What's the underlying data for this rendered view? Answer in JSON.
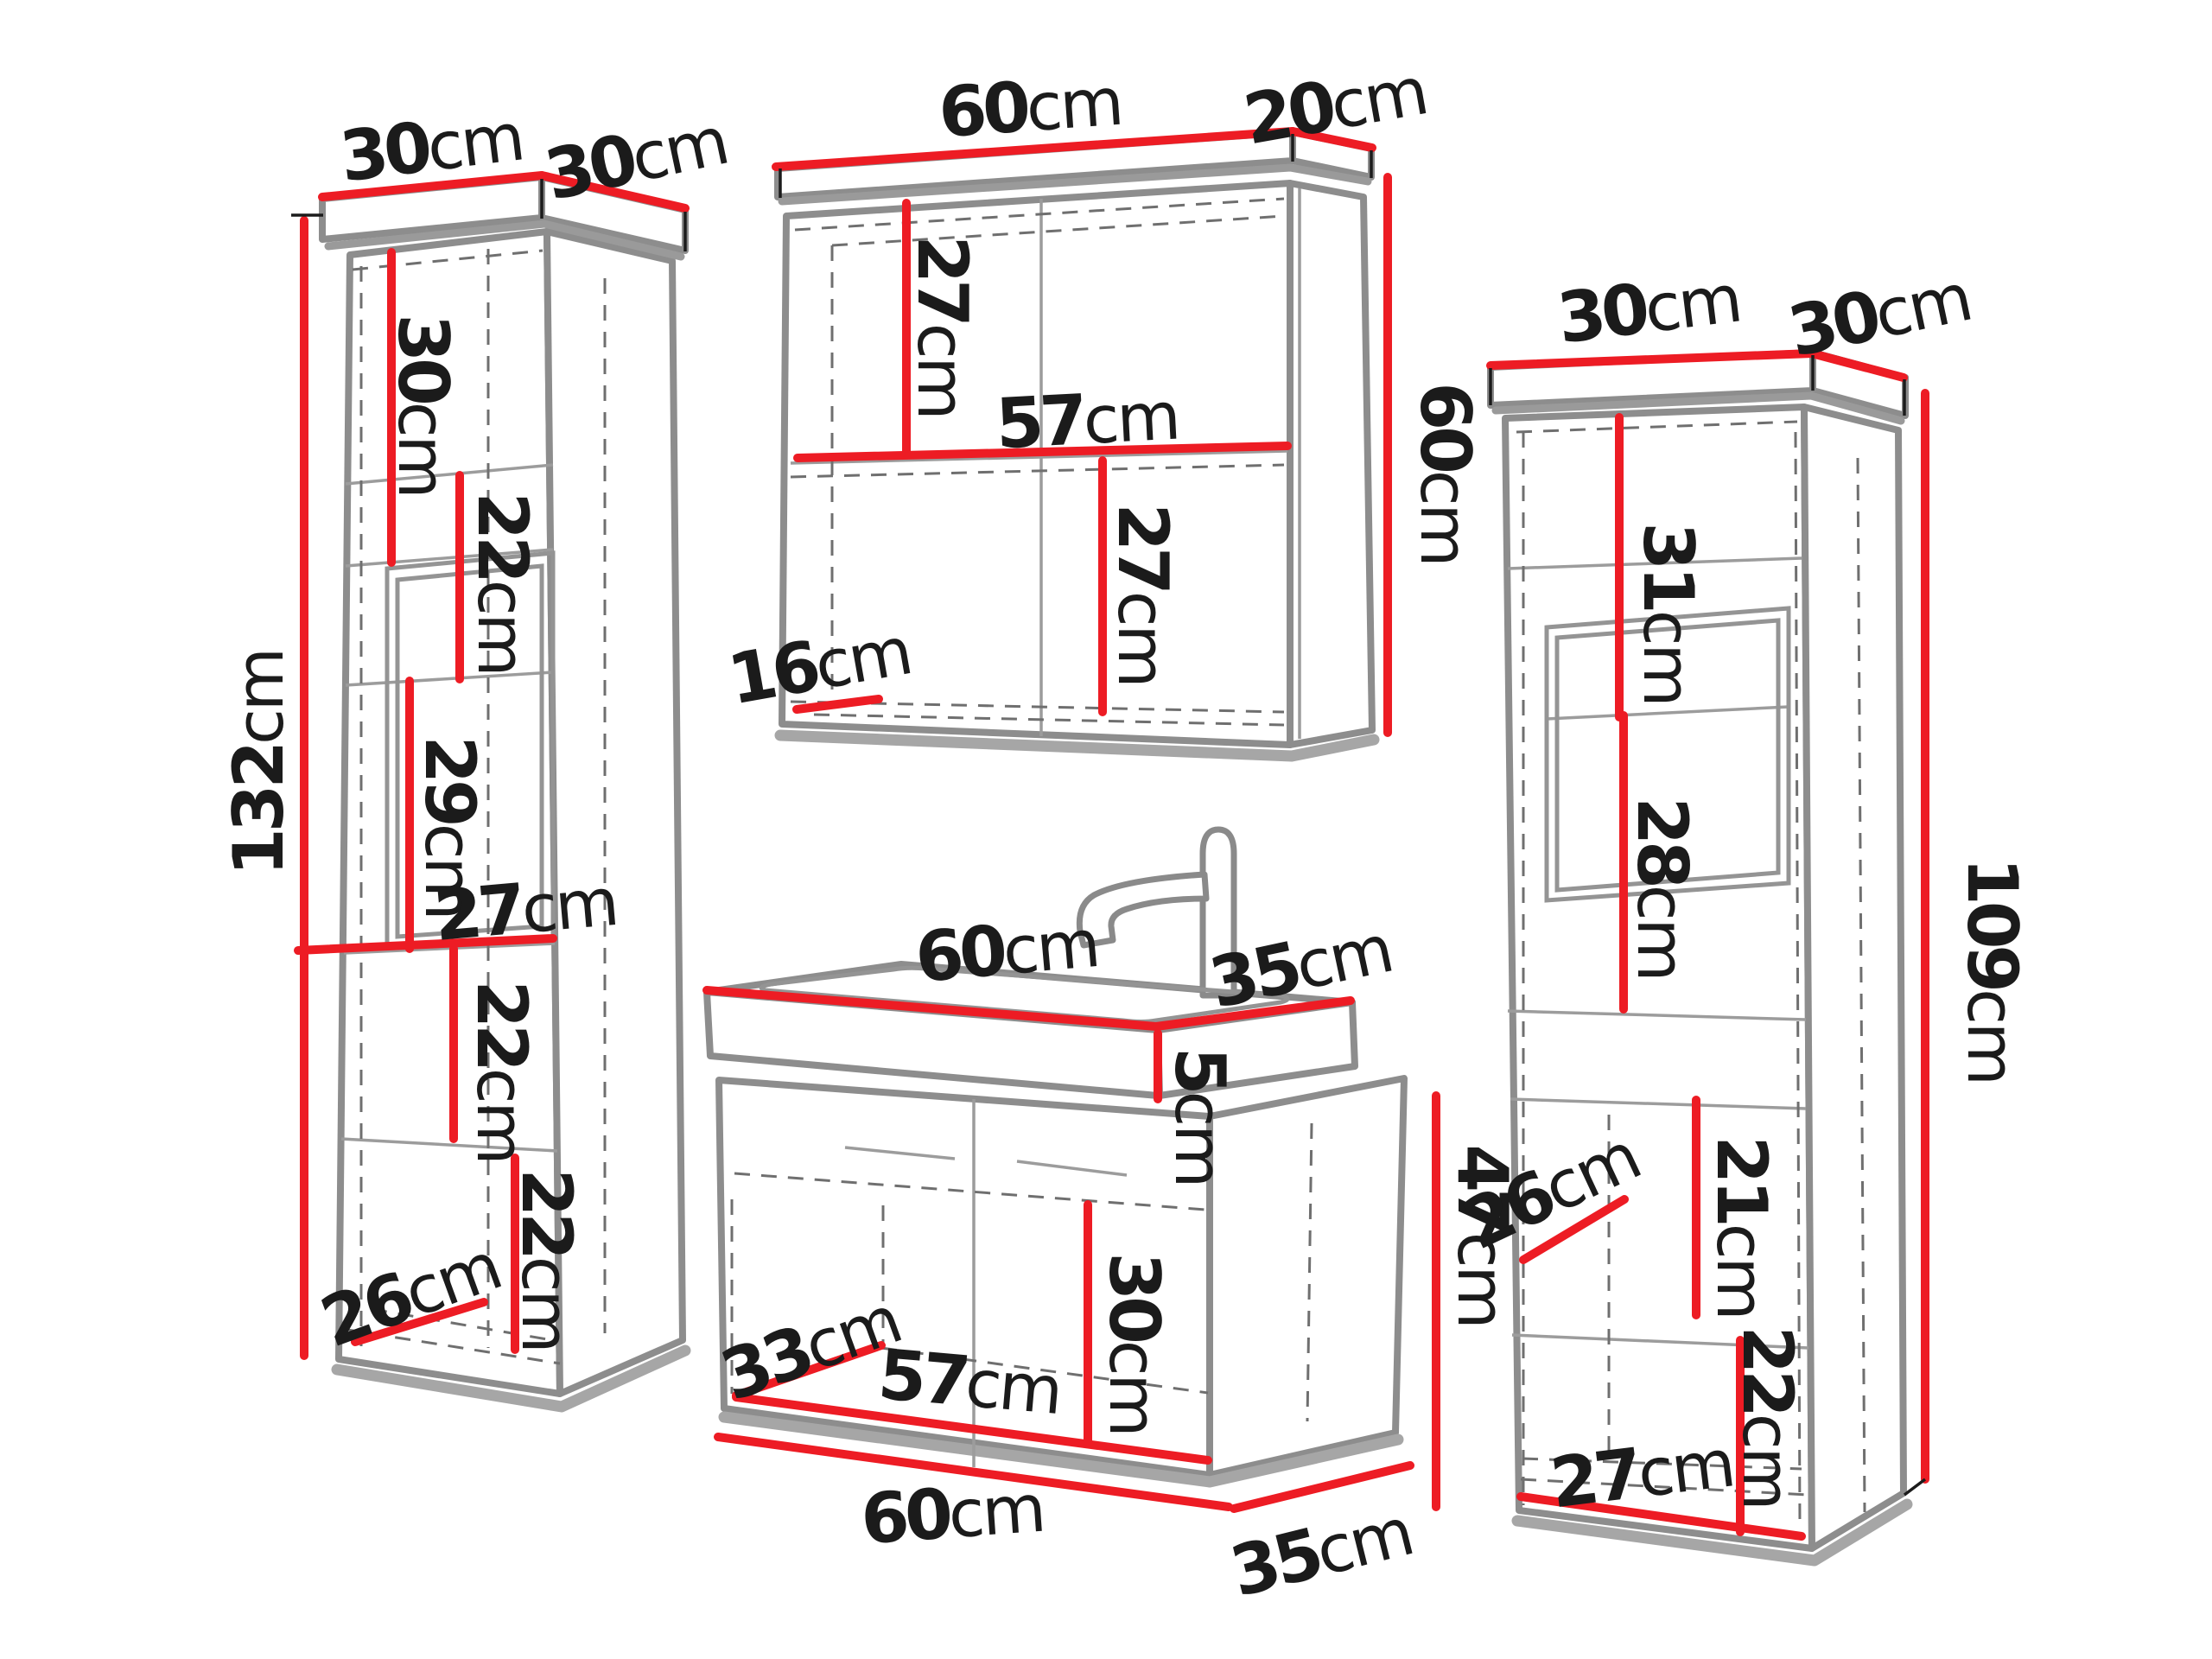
{
  "diagram": {
    "background": "#ffffff",
    "unit": "cm",
    "colors": {
      "dimension_line": "#ed1c24",
      "cabinet_outline": "#8d8d8d",
      "hidden_line": "#6f6f6f",
      "shadow": "#a6a6a6",
      "label_text": "#1b1b1b"
    },
    "cabinets": [
      {
        "id": "tall-cabinet-left",
        "labels": [
          {
            "name": "top-width",
            "num": "30",
            "unit": "cm"
          },
          {
            "name": "top-depth",
            "num": "30",
            "unit": "cm"
          },
          {
            "name": "height",
            "num": "132",
            "unit": "cm"
          },
          {
            "name": "upper-section-height",
            "num": "30",
            "unit": "cm"
          },
          {
            "name": "niche-upper-height",
            "num": "22",
            "unit": "cm"
          },
          {
            "name": "niche-lower-height",
            "num": "29",
            "unit": "cm"
          },
          {
            "name": "interior-width",
            "num": "27",
            "unit": "cm"
          },
          {
            "name": "shelf-section-height",
            "num": "22",
            "unit": "cm"
          },
          {
            "name": "bottom-section-height",
            "num": "22",
            "unit": "cm"
          },
          {
            "name": "interior-depth",
            "num": "26",
            "unit": "cm"
          }
        ]
      },
      {
        "id": "wall-cabinet-top",
        "labels": [
          {
            "name": "top-width",
            "num": "60",
            "unit": "cm"
          },
          {
            "name": "top-depth",
            "num": "20",
            "unit": "cm"
          },
          {
            "name": "upper-interior-height",
            "num": "27",
            "unit": "cm"
          },
          {
            "name": "interior-width",
            "num": "57",
            "unit": "cm"
          },
          {
            "name": "lower-interior-height",
            "num": "27",
            "unit": "cm"
          },
          {
            "name": "interior-depth",
            "num": "16",
            "unit": "cm"
          },
          {
            "name": "height",
            "num": "60",
            "unit": "cm"
          }
        ]
      },
      {
        "id": "sink-vanity-cabinet",
        "labels": [
          {
            "name": "top-width",
            "num": "60",
            "unit": "cm"
          },
          {
            "name": "top-depth",
            "num": "35",
            "unit": "cm"
          },
          {
            "name": "basin-height",
            "num": "5",
            "unit": "cm"
          },
          {
            "name": "body-height",
            "num": "47",
            "unit": "cm"
          },
          {
            "name": "interior-height",
            "num": "30",
            "unit": "cm"
          },
          {
            "name": "interior-depth",
            "num": "33",
            "unit": "cm"
          },
          {
            "name": "interior-width",
            "num": "57",
            "unit": "cm"
          },
          {
            "name": "bottom-width",
            "num": "60",
            "unit": "cm"
          },
          {
            "name": "bottom-depth",
            "num": "35",
            "unit": "cm"
          }
        ]
      },
      {
        "id": "tall-cabinet-right",
        "labels": [
          {
            "name": "top-width",
            "num": "30",
            "unit": "cm"
          },
          {
            "name": "top-depth",
            "num": "30",
            "unit": "cm"
          },
          {
            "name": "niche-height",
            "num": "31",
            "unit": "cm"
          },
          {
            "name": "niche-lower-height",
            "num": "28",
            "unit": "cm"
          },
          {
            "name": "height",
            "num": "109",
            "unit": "cm"
          },
          {
            "name": "shelf-section-height",
            "num": "21",
            "unit": "cm"
          },
          {
            "name": "interior-depth",
            "num": "26",
            "unit": "cm"
          },
          {
            "name": "bottom-section-height",
            "num": "22",
            "unit": "cm"
          },
          {
            "name": "bottom-width",
            "num": "27",
            "unit": "cm"
          }
        ]
      }
    ]
  }
}
